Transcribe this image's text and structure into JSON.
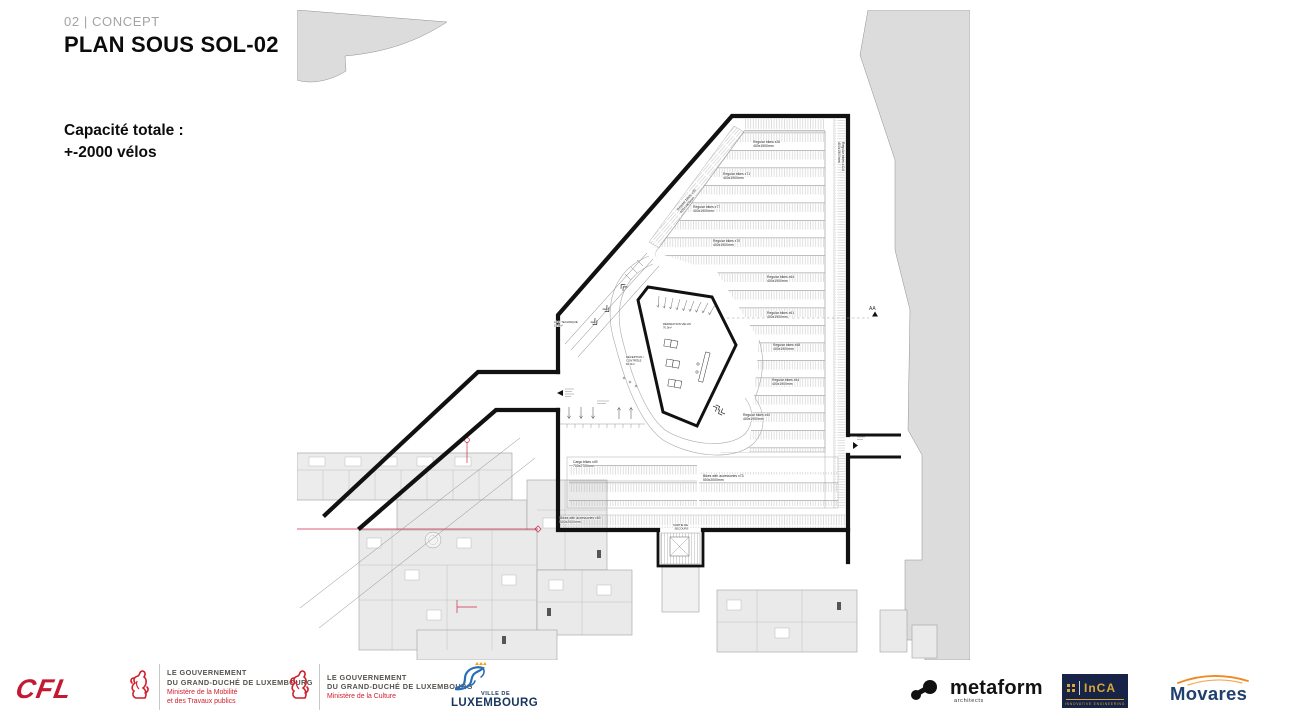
{
  "header": {
    "kicker": "02 | CONCEPT",
    "title": "PLAN SOUS SOL-02",
    "capacity_line1": "Capacité totale :",
    "capacity_line2": "+-2000 vélos"
  },
  "drawing": {
    "rack_rows": [
      {
        "count": "Regular bikes x26",
        "size": "400x1900mm"
      },
      {
        "count": "Regular bikes x71",
        "size": "400x1900mm"
      },
      {
        "count": "Regular bikes x77",
        "size": "400x1900mm"
      },
      {
        "count": "Regular bikes x70",
        "size": "400x1900mm"
      },
      {
        "count": "Regular bikes x64",
        "size": "400x1900mm"
      },
      {
        "count": "Regular bikes x61",
        "size": "400x1900mm"
      },
      {
        "count": "Regular bikes x58",
        "size": "400x1900mm"
      },
      {
        "count": "Regular bikes x54",
        "size": "400x1900mm"
      },
      {
        "count": "Regular bikes x40",
        "size": "400x1900mm"
      }
    ],
    "diag_strip": {
      "l1": "Regular bikes x30",
      "l2": "400x1900mm"
    },
    "right_strip": {
      "l1": "Regular bikes x114",
      "l2": "400x1900mm"
    },
    "cargo": {
      "l1": "Cargo bikes x49",
      "l2": "700x2700mm"
    },
    "accessories_a": {
      "l1": "Bikes with accessories x73",
      "l2": "500x2000mm"
    },
    "accessories_b": {
      "l1": "Bikes with accessories x69",
      "l2": "500x2000mm"
    },
    "repair": {
      "l1": "RÉPARATION VÉLOS",
      "l2": "70.0m²"
    },
    "reception": {
      "l1": "RÉCEPTION /",
      "l2": "CONTRÔLE",
      "l3": "84.0m²"
    },
    "technique": {
      "l1": "LOC. TECHNIQUE",
      "l2": "19.0m²"
    },
    "exit": {
      "l1": "SORTIE DE",
      "l2": "SECOURS"
    },
    "section_marker": "AA"
  },
  "footer": {
    "cfl": "CFL",
    "gov1": {
      "l1": "LE GOUVERNEMENT",
      "l2": "DU GRAND-DUCHÉ DE LUXEMBOURG",
      "m1": "Ministère de la Mobilité",
      "m2": "et des Travaux publics"
    },
    "gov2": {
      "l1": "LE GOUVERNEMENT",
      "l2": "DU GRAND-DUCHÉ DE LUXEMBOURG",
      "m1": "Ministère de la Culture"
    },
    "ville": {
      "l1": "VILLE DE",
      "l2": "LUXEMBOURG"
    },
    "metaform": {
      "name": "metaform",
      "sub": "architects"
    },
    "inca": {
      "name": "InCA",
      "sub": "INNOVATIVE ENGINEERING"
    },
    "movares": "Movares"
  },
  "colors": {
    "wall_black": "#111111",
    "context_gray": "#dcdcdc",
    "building_gray": "#eaeaea",
    "section_red": "#cf2a4e",
    "gov_red": "#cf1f2e",
    "vdl_blue": "#2a6db5",
    "inca_navy": "#172448",
    "inca_gold": "#d9a732",
    "movares_navy": "#20406e",
    "movares_orange": "#ef8a1f"
  }
}
